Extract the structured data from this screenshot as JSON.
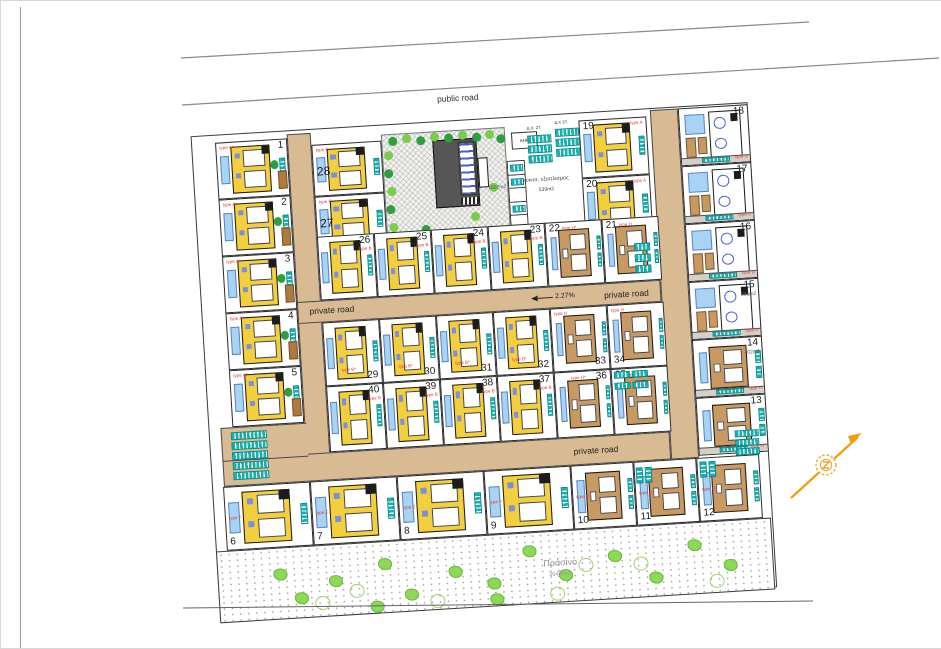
{
  "labels": {
    "public_road": "public road",
    "private_road_left": "private road",
    "private_road_right": "private road",
    "private_road_bottom": "private road",
    "slope": "2.27%",
    "green_title": "Πράσινο",
    "green_area": "3643m2",
    "communal_equipment": "κοινοτ. εξοπλισμος",
    "communal_equipment_area": "539m2",
    "communal_green_area": "1602m2",
    "ahk": "ΑΗΚ",
    "parking_label_1": "Δ.Χ. 2Τ.",
    "parking_label_2": "Δ.Χ 2Τ."
  },
  "plot_groups": {
    "left_column": [
      {
        "number": "1",
        "type": "type A*"
      },
      {
        "number": "2",
        "type": "type A*"
      },
      {
        "number": "3",
        "type": "type A*"
      },
      {
        "number": "4",
        "type": "type A*"
      },
      {
        "number": "5",
        "type": "type A*"
      }
    ],
    "top_c": [
      {
        "number": "28",
        "type": "type C"
      },
      {
        "number": "27",
        "type": "type C"
      }
    ],
    "top_a": [
      {
        "number": "19",
        "type": "type A"
      },
      {
        "number": "20",
        "type": "type A"
      }
    ],
    "row_upper": [
      {
        "number": "26",
        "type": "type B"
      },
      {
        "number": "25",
        "type": "type B"
      },
      {
        "number": "24",
        "type": "type B"
      },
      {
        "number": "23",
        "type": "type B"
      },
      {
        "number": "22",
        "type": "type H*"
      },
      {
        "number": "21",
        "type": "type H"
      }
    ],
    "mid_row_a": [
      {
        "number": "29",
        "type": "type B*"
      },
      {
        "number": "30",
        "type": "type B*"
      },
      {
        "number": "31",
        "type": "type B*"
      },
      {
        "number": "32",
        "type": "type B*"
      },
      {
        "number": "33",
        "type": "type H"
      },
      {
        "number": "34",
        "type": "type H"
      }
    ],
    "mid_row_b": [
      {
        "number": "40",
        "type": "type B"
      },
      {
        "number": "39",
        "type": "type B"
      },
      {
        "number": "38",
        "type": "type B"
      },
      {
        "number": "37",
        "type": "type B"
      },
      {
        "number": "36",
        "type": "type H*"
      },
      {
        "number": "35",
        "type": "type H"
      }
    ],
    "bottom_row": [
      {
        "number": "6",
        "type": "type F"
      },
      {
        "number": "7",
        "type": "type E"
      },
      {
        "number": "8",
        "type": "type E"
      },
      {
        "number": "9",
        "type": "type F"
      },
      {
        "number": "10",
        "type": "type H"
      },
      {
        "number": "11",
        "type": "type H"
      },
      {
        "number": "12",
        "type": "type H"
      }
    ],
    "right_column": [
      {
        "number": "18",
        "type": "type D"
      },
      {
        "number": "17",
        "type": "type D"
      },
      {
        "number": "16",
        "type": "type D"
      },
      {
        "number": "15",
        "type": "type D",
        "area": "386m2"
      },
      {
        "number": "14",
        "type": "type H",
        "area": "402m2"
      },
      {
        "number": "13",
        "type": "type H*"
      }
    ]
  },
  "colors": {
    "road": "#d8bb92",
    "parking": "#12b3b3",
    "house_yellow": "#f4cf3d",
    "house_brown": "#c99962",
    "pool": "#a9d3f2",
    "green": "#8cd957",
    "type_label": "#e03a3a",
    "north_arrow": "#f39c12"
  },
  "compass": {
    "icon": "north-arrow"
  }
}
